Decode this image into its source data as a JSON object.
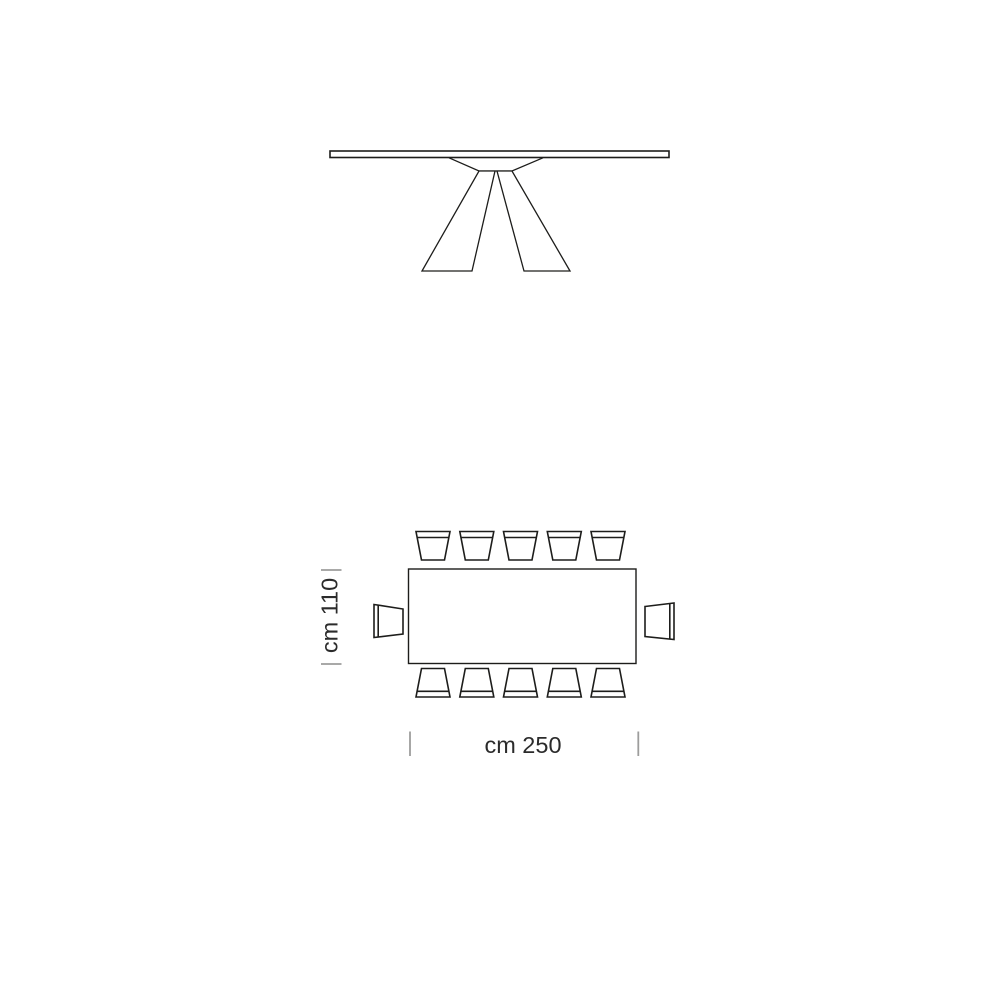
{
  "diagram": {
    "dimensions": {
      "width": {
        "label": "cm 250"
      },
      "depth": {
        "label": "cm 110"
      }
    },
    "seating": {
      "top": 5,
      "bottom": 5,
      "left": 1,
      "right": 1,
      "total": 12
    },
    "colors": {
      "line": "#1d1d1b",
      "tick": "#9d9d9c",
      "text": "#2b2b2b",
      "background": "#ffffff"
    }
  }
}
